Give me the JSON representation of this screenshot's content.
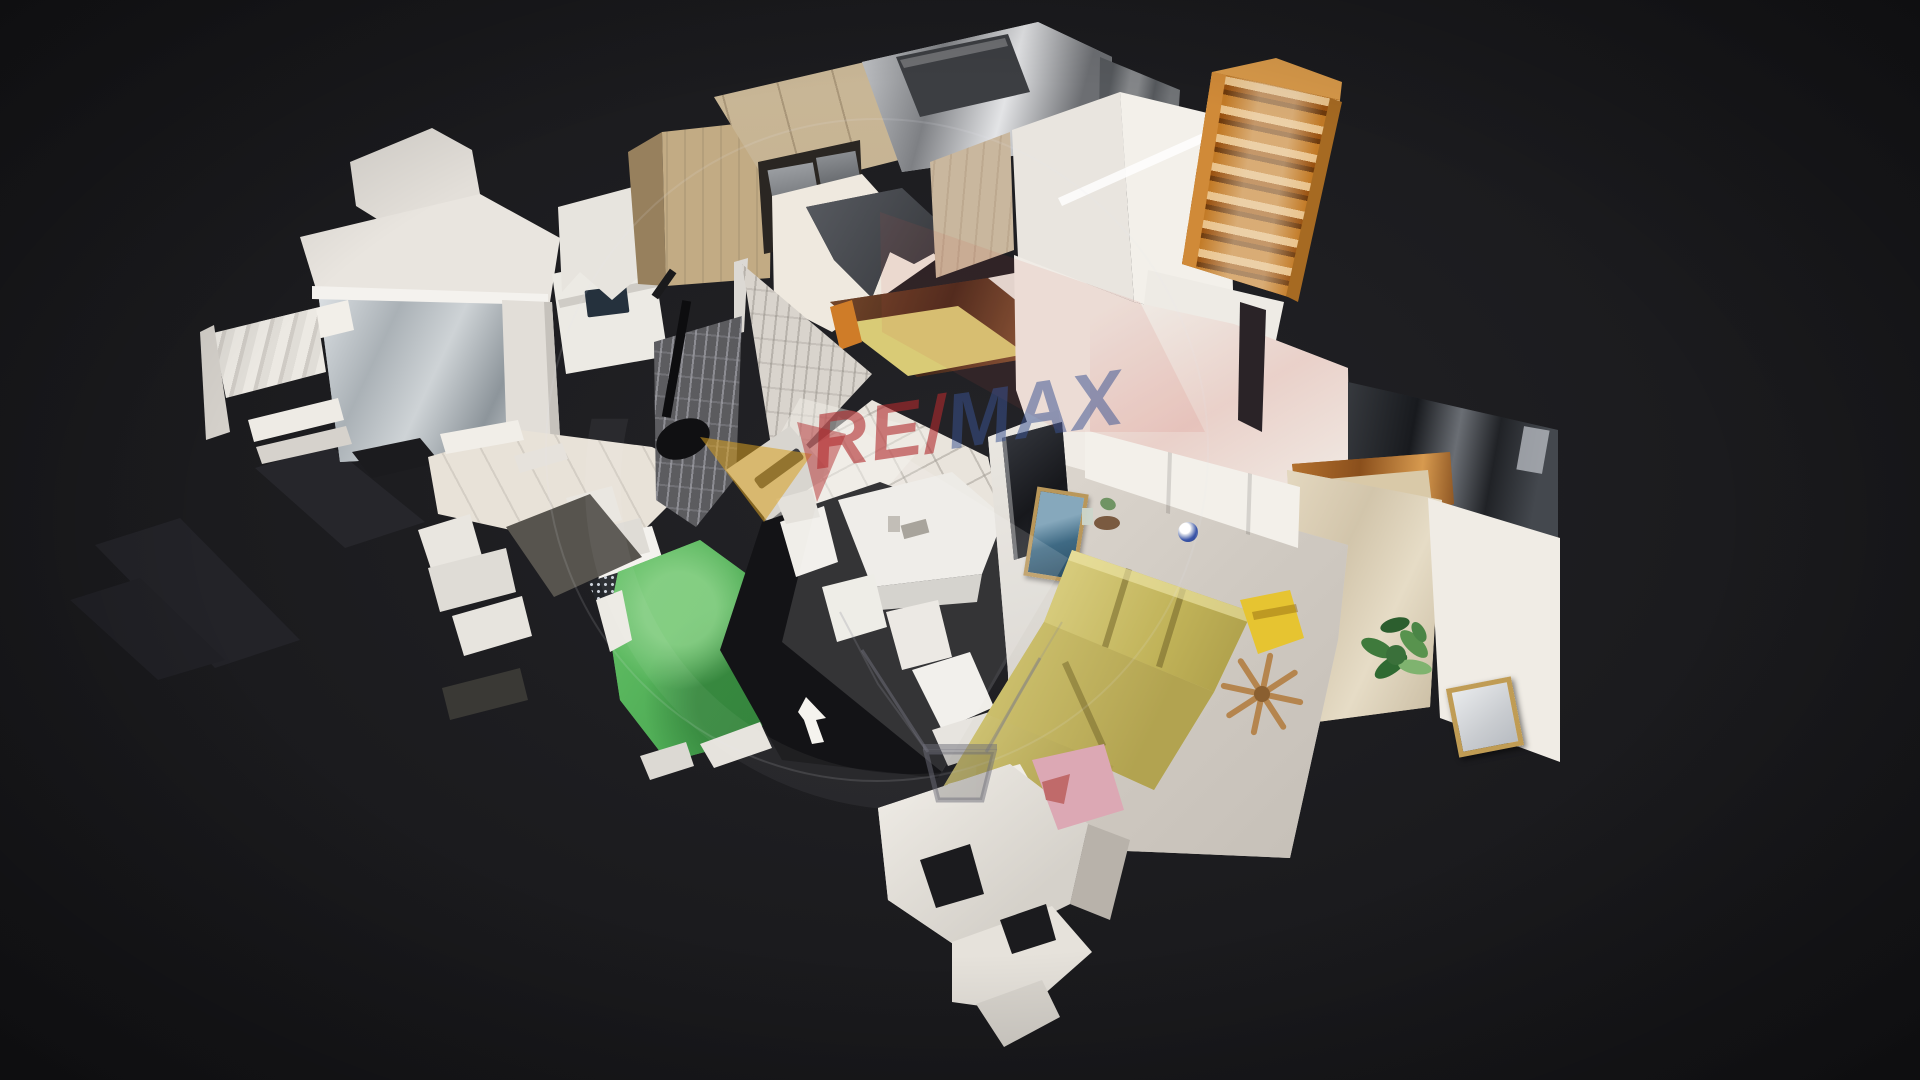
{
  "viewer": {
    "type": "3d-dollhouse-view",
    "scene": "apartment 3D scan dollhouse view on dark background",
    "rooms": [
      "kitchen",
      "staircase",
      "shower-bathroom",
      "laundry-area",
      "hallway",
      "dining-area",
      "living-room",
      "bedroom"
    ]
  },
  "watermark": {
    "text_red": "RE/",
    "text_blue": "MAX",
    "element": "remax-balloon-logo-with-basket"
  },
  "colors": {
    "bg": "#1b1b1e",
    "wall-white": "#f2efe9",
    "wall-pink": "#eddcd7",
    "wood-cabinet": "#c2ab84",
    "stairs-wood": "#c27a26",
    "brick-dark": "#4f4f53",
    "brick-pale": "#d9d4cd",
    "floor-tile": "#e9e4dc",
    "floor-living": "#d6d0c8",
    "sofa-yellow": "#cbbe65",
    "bed-green": "#4fae54",
    "bedspread": "#d9ccb2",
    "mat-gray": "#57544e",
    "metal-dark": "#26282c",
    "tv-dark": "#25272c",
    "frame-gold": "#c09c54",
    "watermark-red": "#b02a2d",
    "watermark-blue": "#3a5291",
    "watermark-gold": "#d9a020",
    "basket-line": "#6a6a74"
  }
}
